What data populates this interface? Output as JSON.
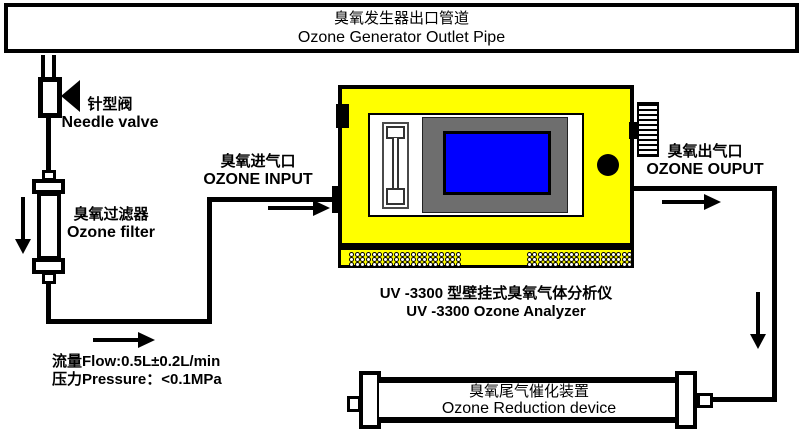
{
  "banner": {
    "title_cn": "臭氧发生器出口管道",
    "title_en": "Ozone Generator Outlet Pipe"
  },
  "needle_valve": {
    "label_cn": "针型阀",
    "label_en": "Needle valve"
  },
  "ozone_filter": {
    "label_cn": "臭氧过滤器",
    "label_en": "Ozone filter"
  },
  "ozone_input": {
    "label_cn": "臭氧进气口",
    "label_en": "OZONE INPUT"
  },
  "ozone_output": {
    "label_cn": "臭氧出气口",
    "label_en": "OZONE OUPUT"
  },
  "analyzer": {
    "caption_cn": "UV -3300 型壁挂式臭氧气体分析仪",
    "caption_en": "UV -3300 Ozone Analyzer"
  },
  "reduction_device": {
    "label_cn": "臭氧尾气催化装置",
    "label_en": "Ozone Reduction device"
  },
  "specs": {
    "flow": "流量Flow:0.5L±0.2L/min",
    "pressure": "压力Pressure：<0.1MPa"
  },
  "icons": {
    "flow_arrows": [
      "down-arrow",
      "right-arrow-to-analyzer",
      "right-arrow-under-filter",
      "right-arrow-output",
      "down-arrow-to-device"
    ],
    "valve_symbol": "left-pointing-triangle",
    "heat_sink": "finned-vent"
  },
  "colors": {
    "analyzer_body": "#FFFF00",
    "screen": "#0000FF",
    "screen_bezel": "#6E6E6E",
    "line": "#000000",
    "background": "#FFFFFF"
  },
  "vents": {
    "groups": 2,
    "rows": 3,
    "dots_per_row": 20
  }
}
